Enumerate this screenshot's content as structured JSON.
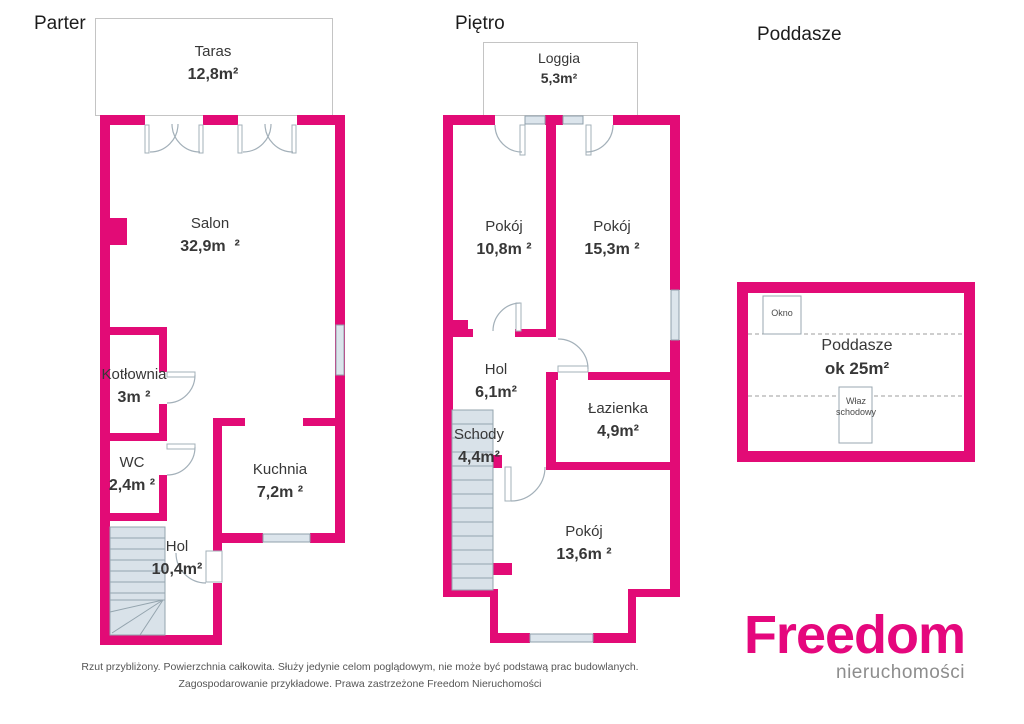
{
  "colors": {
    "wall": "#e20b76",
    "brand_pink": "#e5077d",
    "window_fill": "#dce5ec",
    "stairs_fill": "#d9e2e9",
    "text": "#373737",
    "disclaimer_gray": "#555555",
    "logo_sub_gray": "#8d8d8d"
  },
  "floors": [
    {
      "title": "Parter",
      "rooms": [
        {
          "name": "Taras",
          "area": "12,8m²"
        },
        {
          "name": "Salon",
          "area": "32,9m  ²"
        },
        {
          "name": "Kotłownia",
          "area": "3m ²"
        },
        {
          "name": "WC",
          "area": "2,4m ²"
        },
        {
          "name": "Kuchnia",
          "area": "7,2m ²"
        },
        {
          "name": "Hol",
          "area": "10,4m²"
        }
      ]
    },
    {
      "title": "Piętro",
      "rooms": [
        {
          "name": "Loggia",
          "area": "5,3m²"
        },
        {
          "name": "Pokój",
          "area": "10,8m ²"
        },
        {
          "name": "Pokój",
          "area": "15,3m ²"
        },
        {
          "name": "Hol",
          "area": "6,1m²"
        },
        {
          "name": "Schody",
          "area": "4,4m²"
        },
        {
          "name": "Łazienka",
          "area": "4,9m²"
        },
        {
          "name": "Pokój",
          "area": "13,6m ²"
        }
      ]
    },
    {
      "title": "Poddasze",
      "rooms": [
        {
          "name": "Poddasze",
          "area": "ok 25m²"
        }
      ],
      "annotations": {
        "window": "Okno",
        "hatch": "Właz schodowy"
      }
    }
  ],
  "footer": {
    "disclaimer_line1": "Rzut przybliżony. Powierzchnia całkowita. Służy jedynie celom poglądowym, nie może być podstawą prac budowlanych.",
    "disclaimer_line2": "Zagospodarowanie przykładowe. Prawa zastrzeżone Freedom Nieruchomości",
    "brand": "Freedom",
    "brand_sub": "nieruchomości"
  }
}
